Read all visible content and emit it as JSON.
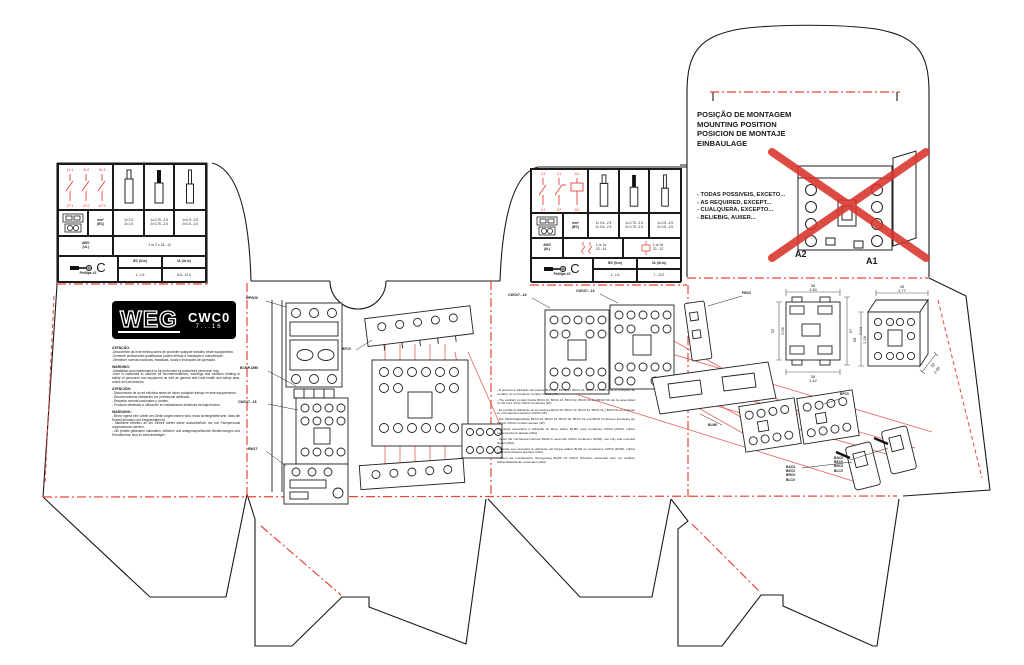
{
  "brand": {
    "logo": "WEG",
    "model": "CWC0",
    "range": "7...16"
  },
  "mounting": {
    "titles": "POSIÇÃO DE MONTAGEM\nMOUNTING POSITION\nPOSICION DE MONTAJE\nEINBAULAGE",
    "bullets": "- TODAS POSSIVEIS, EXCETO...\n- AS REQUIRED, EXCEPT...\n- CUALQUERA, EXCEPTO...\n- BELIEBIG, AUßER...",
    "a2": "A2",
    "a1": "A1"
  },
  "warnings": [
    {
      "title": "ATENÇÃO:",
      "body": "-Desconecte da rede elétrica antes de proceder qualquer trabalho neste equipamento.\n-Somente profissionais qualificados podem efetuar a instalação e manutenção.\n-Obedecer normas nacionais, estaduais, locais e instruções de operação."
    },
    {
      "title": "WARNING:",
      "body": "-Installation and maintenance to be performed by authorized personnel only.\n-User is cautioned to observe all recommendations, warnings and cautions relating to safety of personnel and equipment as well as general and local health and safety laws, codes and procedures."
    },
    {
      "title": "ATENCIÓN:",
      "body": "- Desconectar de la red eléctrica antes de hacer cualquier trabajo en este equipamiento.\n- Recomendamos instalación por profesional calificado.\n- Respetar normas nacionales y locales.\n- Producto destinado a utilización en instalaciones eléctricas de baja tensión."
    },
    {
      "title": "WARNUNG:",
      "body": "- Bevor irgend eine Arbeit am Gerät vorgenommen wird, muss sichergestellt sein, dass die Einheit stromlos und freigeschaltet ist.\n- Sämtliche Arbeiten an der Einheit dürfen daher ausschließlich nur von Fachpersonal vorgenommen werden.\n- Die jeweils geltenden nationalen, örtlichen und anlagenspezifischen Bestimmungen und Erfordernisse sind zu berücksichtigen."
    }
  ],
  "table_left": {
    "t1": "1L1",
    "t2": "3L2",
    "t3": "5L3",
    "b1": "2T1",
    "b2": "4T2",
    "b3": "6T3",
    "mm2_label": "mm²",
    "mm2_sub": "(IEC)",
    "mm2_a": "1x 2.5\n2x 1.5",
    "mm2_b": "1x 0.75...2.5\n2x 0.75...2.5",
    "mm2_c": "1x 0.5...2.5\n2x 0.5...2.5",
    "awg_label": "AWG",
    "awg_sub": "(UL)",
    "awg": "1 or 2 x 18...12",
    "screw": "Phillips #2",
    "iec_label": "IEC (N.m)",
    "iec": "1...1.5",
    "ul_label": "UL (lb.in)",
    "ul": "8.8...13.3"
  },
  "table_mid": {
    "t1": "13",
    "t2": "21",
    "t3": "A1",
    "b1": "14",
    "b2": "22",
    "b3": "A2",
    "mm2_label": "mm²",
    "mm2_sub": "(IEC)",
    "mm2_a": "1x 0.5...2.5\n2x 0.5...2.5",
    "mm2_b": "1x 0.75...2.5\n2x 0.75...2.5",
    "mm2_c": "1x 0.5...2.5\n2x 0.5...2.5",
    "awg_label": "AWG",
    "awg_sub": "(UL)",
    "awg_a": "1 or 2x\n22...14",
    "awg_b": "1 or 2x\n22...12",
    "screw": "Phillips #2",
    "iec_label": "IEC (N.m)",
    "iec": "1...1.5",
    "ul_label": "UL (lb.in)",
    "ul": "7...13.3"
  },
  "dims": {
    "s_top": "38",
    "s_top2": "1.50",
    "s_left": "52",
    "s_left2": "2.05",
    "s_right": "57",
    "s_right2": "2.24",
    "s_bot": "36",
    "s_bot2": "1.42",
    "f_top": "45",
    "f_top2": "1.77",
    "f_left": "58",
    "f_left2": "2.28",
    "f_diag": "52",
    "f_diag2": "2.05"
  },
  "labels": [
    {
      "text": "MPW16"
    },
    {
      "text": "BCMP-DM0"
    },
    {
      "text": "CWC07...16"
    },
    {
      "text": "RW17"
    },
    {
      "text": "BFC0"
    },
    {
      "text": "CWC07...16"
    },
    {
      "text": "CWC07...16"
    },
    {
      "text": "PBC0"
    },
    {
      "text": "BLM0"
    },
    {
      "text": "BFC0"
    },
    {
      "text": "BAC0\nBEC0\nBRC0\nBLC0"
    },
    {
      "text": "BAC0\nBEC0\nBRC0\nBLC0"
    }
  ],
  "instructions": [
    "- É possível a utilização dos blocos BFC0 40, BFC0 13, BFC0 22, BFC0 31 e BFC0 04 em conjunto ao contator, 2x no frontal do contator CWC0 (4P).",
    "- The auxiliary contact blocks BFC0 40, BFC0 13, BFC0 22, BFC0 31 and BFC0 04 can be assembled on the front of the CWC0 contactors (4P).",
    "- Es posible la utilización de los bloques BFC0 40, BFC0 13, BFC0 22, BFC0 31 y BFC0 04 en conjunto en el frontal del contactor CWC0 (4P).",
    "- Die Hilfsschalterblöcke BFC0 40, BFC0 13, BFC0 22, BFC0 31 und BFC0 04 können frontseitig am Schütz CWC0 montiert werden (4P).",
    "- Quando necessária a utilização do bloco aditivo BLM0, para contatores CWC0 (2P2R), utilizar somente blocos laterais (2NA).",
    "- When the mechanical interlock BLM0 is used with CWC0 contactors (2P2R), use only side mounted blocks (2NA).",
    "- Cuando sea necesaria la utilización del bloque aditivo BLM0 en contactores CWC0 (2P2R), utilizar solamente bloques laterales (2NA).",
    "- Wenn die mechanische Verriegelung BLM0 mit CWC0 Schützen verwendet wird, nur seitliche Hilfsschalterblöcke verwenden (2NA)."
  ],
  "colors": {
    "fold_red": "#e8453c",
    "cross_red": "#d9342b",
    "cut_black": "#1a1a1a"
  }
}
